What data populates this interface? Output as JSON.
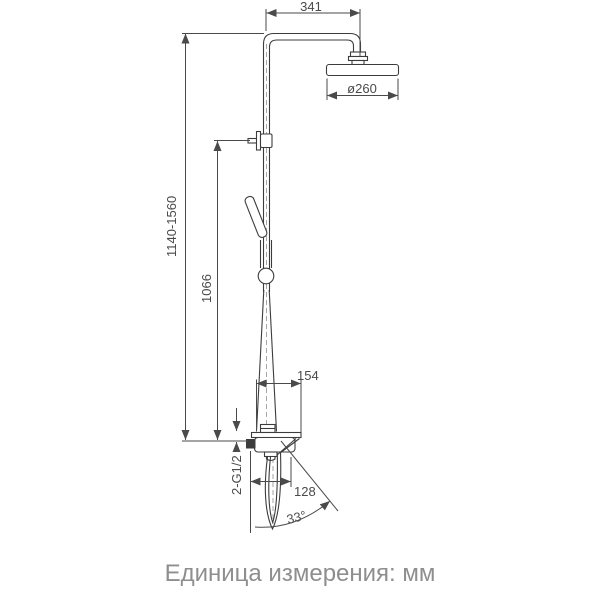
{
  "colors": {
    "line": "#3c3c3c",
    "dim": "#4a4a4a",
    "caption": "#8e8e8e",
    "bg": "#ffffff"
  },
  "diagram": {
    "type": "technical-dimension-drawing",
    "subject": "shower-column-with-rain-head-hand-shower-and-mixer",
    "dimensions": {
      "arm_offset": "341",
      "head_diameter": "ø260",
      "column_height_range": "1140-1560",
      "rail_height": "1066",
      "shelf_depth": "154",
      "spout_reach": "128",
      "spout_angle": "33°",
      "inlet_thread": "2-G1/2"
    },
    "caption": "Единица измерения: мм"
  }
}
